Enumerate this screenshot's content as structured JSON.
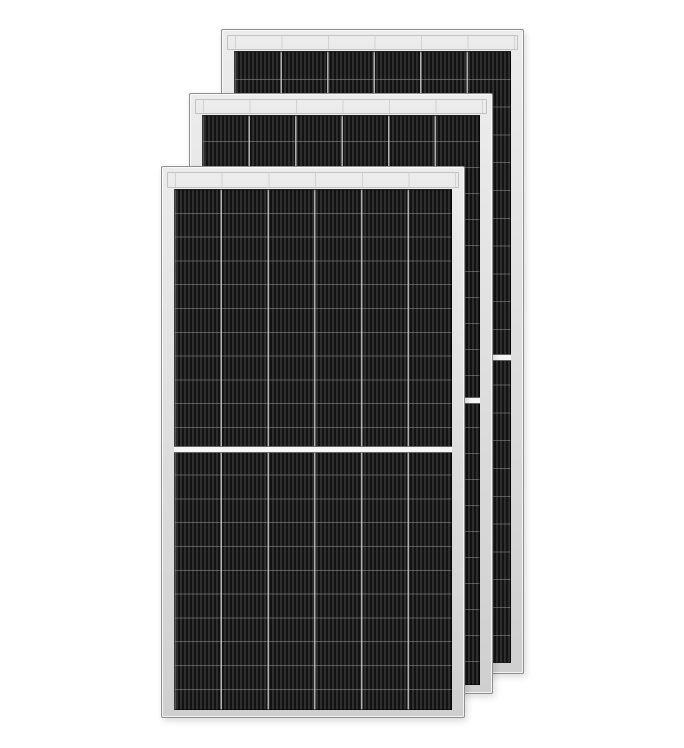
{
  "scene": {
    "type": "product-photo",
    "description": "Three identical all-black half-cut monocrystalline solar PV panels with silver frames, arranged in an overlapping fanned stack on a plain white background",
    "background_color": "#ffffff",
    "panel_count": 3
  },
  "panels": [
    {
      "id": "back",
      "label": "Solar panel (back of stack)",
      "columns": 6,
      "rows": 22,
      "half_cut": true,
      "top_busbar_strip": true
    },
    {
      "id": "middle",
      "label": "Solar panel (middle of stack)",
      "columns": 6,
      "rows": 22,
      "half_cut": true,
      "top_busbar_strip": true
    },
    {
      "id": "front",
      "label": "Solar panel (front of stack)",
      "columns": 6,
      "rows": 22,
      "half_cut": true,
      "top_busbar_strip": true
    }
  ],
  "palette": {
    "bg": "#ffffff",
    "frame-light": "#ececec",
    "frame-mid": "#cfcfcf",
    "frame-edge": "#8f8f8f",
    "busbar-white": "#f6f6f6",
    "cell-base": "#1b1b1b",
    "stripe-dark": "#121212",
    "stripe-light": "#2e2e2e",
    "grid-line": "#b5b5b5"
  }
}
